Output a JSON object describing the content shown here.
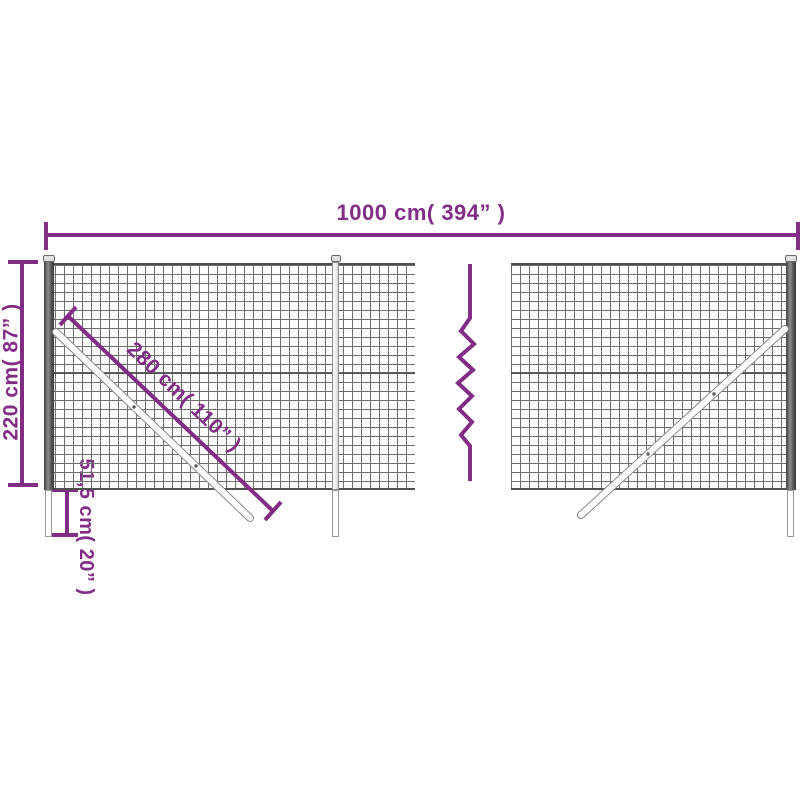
{
  "diagram": {
    "dimensions": {
      "width": "1000 cm( 394” )",
      "height": "220 cm( 87” )",
      "brace": "280 cm( 110” )",
      "underground": "51,5 cm( 20” )"
    },
    "colors": {
      "dimension_purple": "#822b87",
      "mesh_wire_gray": "#6d6d6d",
      "post_dark_gray": "#4a4a4a",
      "brace_outline_gray": "#8a8a8a",
      "background": "#ffffff"
    }
  }
}
